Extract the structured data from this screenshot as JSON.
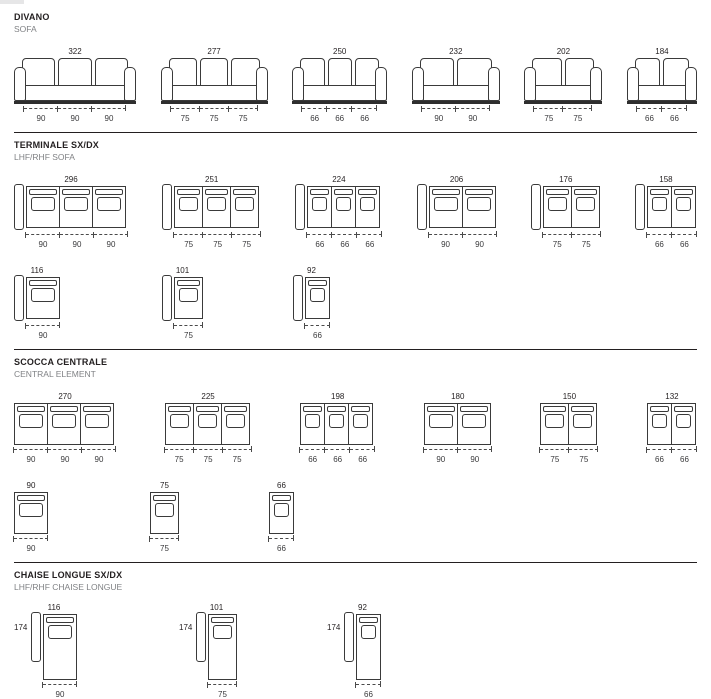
{
  "colors": {
    "line": "#3a3a3a",
    "heading": "#231f20",
    "muted": "#808285",
    "dimension": "#39393b"
  },
  "document": {
    "sections": [
      {
        "id": "divano",
        "title": "DIVANO",
        "subtitle": "SOFA",
        "style": "front",
        "armrests": "both",
        "rows": [
          {
            "items": [
              {
                "total": "322",
                "seats": [
                  "90",
                  "90",
                  "90"
                ]
              },
              {
                "total": "277",
                "seats": [
                  "75",
                  "75",
                  "75"
                ]
              },
              {
                "total": "250",
                "seats": [
                  "66",
                  "66",
                  "66"
                ]
              },
              {
                "total": "232",
                "seats": [
                  "90",
                  "90"
                ]
              },
              {
                "total": "202",
                "seats": [
                  "75",
                  "75"
                ]
              },
              {
                "total": "184",
                "seats": [
                  "66",
                  "66"
                ]
              }
            ]
          }
        ]
      },
      {
        "id": "terminale",
        "title": "TERMINALE SX/DX",
        "subtitle": "LHF/RHF SOFA",
        "style": "top",
        "armrests": "left",
        "rows": [
          {
            "items": [
              {
                "total": "296",
                "seats": [
                  "90",
                  "90",
                  "90"
                ]
              },
              {
                "total": "251",
                "seats": [
                  "75",
                  "75",
                  "75"
                ]
              },
              {
                "total": "224",
                "seats": [
                  "66",
                  "66",
                  "66"
                ]
              },
              {
                "total": "206",
                "seats": [
                  "90",
                  "90"
                ]
              },
              {
                "total": "176",
                "seats": [
                  "75",
                  "75"
                ]
              },
              {
                "total": "158",
                "seats": [
                  "66",
                  "66"
                ]
              }
            ]
          },
          {
            "items": [
              {
                "total": "116",
                "seats": [
                  "90"
                ]
              },
              {
                "total": "101",
                "seats": [
                  "75"
                ]
              },
              {
                "total": "92",
                "seats": [
                  "66"
                ]
              }
            ]
          }
        ]
      },
      {
        "id": "scocca",
        "title": "SCOCCA CENTRALE",
        "subtitle": "CENTRAL ELEMENT",
        "style": "top",
        "armrests": "none",
        "rows": [
          {
            "items": [
              {
                "total": "270",
                "seats": [
                  "90",
                  "90",
                  "90"
                ]
              },
              {
                "total": "225",
                "seats": [
                  "75",
                  "75",
                  "75"
                ]
              },
              {
                "total": "198",
                "seats": [
                  "66",
                  "66",
                  "66"
                ]
              },
              {
                "total": "180",
                "seats": [
                  "90",
                  "90"
                ]
              },
              {
                "total": "150",
                "seats": [
                  "75",
                  "75"
                ]
              },
              {
                "total": "132",
                "seats": [
                  "66",
                  "66"
                ]
              }
            ]
          },
          {
            "items": [
              {
                "total": "90",
                "seats": [
                  "90"
                ]
              },
              {
                "total": "75",
                "seats": [
                  "75"
                ]
              },
              {
                "total": "66",
                "seats": [
                  "66"
                ]
              }
            ]
          }
        ]
      },
      {
        "id": "chaise",
        "title": "CHAISE LONGUE SX/DX",
        "subtitle": "LHF/RHF CHAISE LONGUE",
        "style": "chaise",
        "armrests": "left",
        "rows": [
          {
            "items": [
              {
                "total": "116",
                "depth": "174",
                "seats": [
                  "90"
                ]
              },
              {
                "total": "101",
                "depth": "174",
                "seats": [
                  "75"
                ]
              },
              {
                "total": "92",
                "depth": "174",
                "seats": [
                  "66"
                ]
              }
            ]
          }
        ]
      }
    ]
  }
}
